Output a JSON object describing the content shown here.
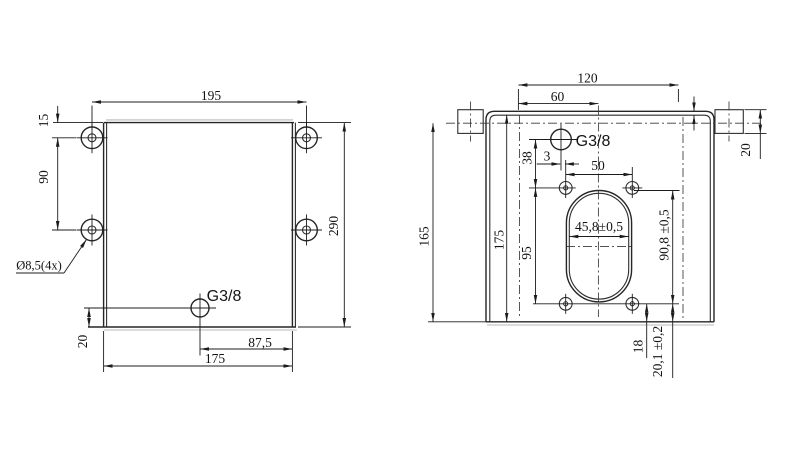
{
  "drawing": {
    "front": {
      "dim_width_top": "195",
      "dim_edge_offset": "15",
      "dim_hole_pitch": "90",
      "dim_height": "290",
      "hole_note": "Ø8,5(4x)",
      "port_label": "G3/8",
      "dim_port_bottom": "20",
      "dim_port_right": "87,5",
      "dim_width_bottom": "175"
    },
    "side": {
      "dim_width": "120",
      "dim_center": "60",
      "dim_flange_height": "20",
      "dim_height_overall": "165",
      "dim_height_face": "175",
      "dim_port_to_holes": "38",
      "dim_hole_rows": "95",
      "dim_port_offset": "3",
      "dim_hole_span": "50",
      "dim_slot_width": "45,8±0,5",
      "dim_slot_height": "90,8 ±0,5",
      "dim_holes_bottom": "18",
      "dim_slot_bottom": "20,1 ±0,2",
      "port_label": "G3/8"
    }
  }
}
